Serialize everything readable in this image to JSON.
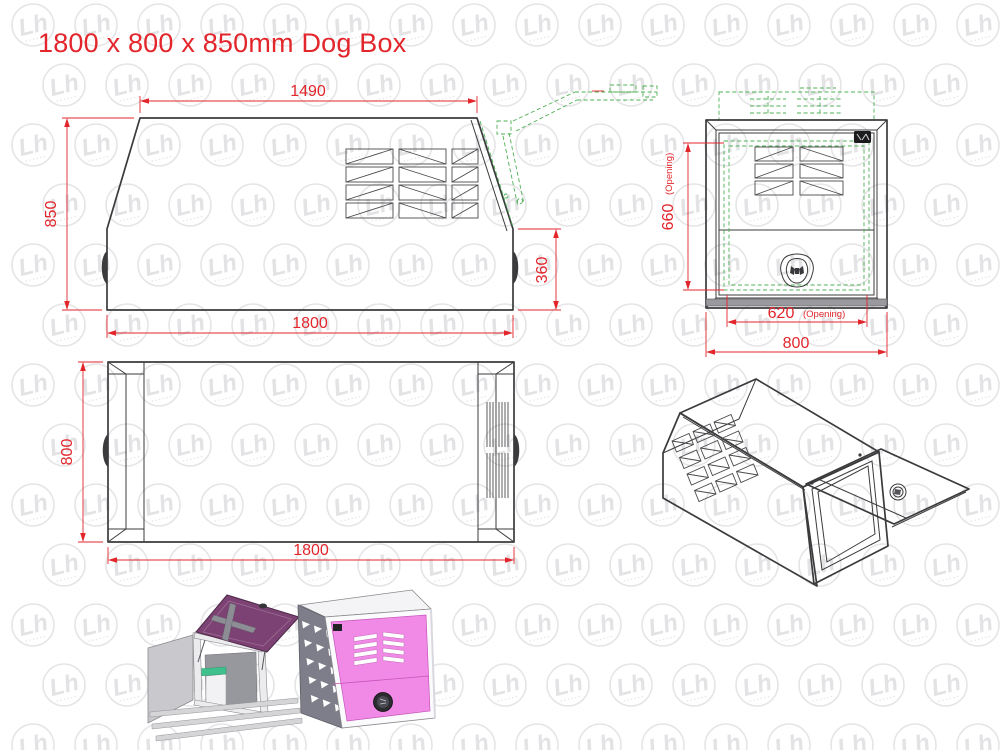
{
  "title": "1800 x 800 x 850mm Dog Box",
  "colors": {
    "red": "#e2262c",
    "green": "#4fb054",
    "line": "#3b3b3d",
    "line_thin": "#4a4a4c",
    "watermark": "#e5e5e8",
    "watermark_glyph": "#e3e3e6",
    "pink": "#f08ae6",
    "purple": "#7c4273",
    "body_gray": "#c9c9cd",
    "panel_dark_gray": "#7e7e8a",
    "shelf_green": "#3fc08c"
  },
  "views": {
    "side_elevation": {
      "dims": {
        "top_width": "1490",
        "height": "850",
        "rear_panel_height": "360",
        "overall_length": "1800"
      }
    },
    "front": {
      "dims": {
        "opening_height": "660",
        "opening_height_note": "(Opening)",
        "opening_width": "620",
        "opening_width_note": "(Opening)",
        "overall_width": "800"
      }
    },
    "plan": {
      "dims": {
        "overall_width": "800",
        "overall_length": "1800"
      }
    }
  },
  "watermark": {
    "glyph": "Lh"
  }
}
